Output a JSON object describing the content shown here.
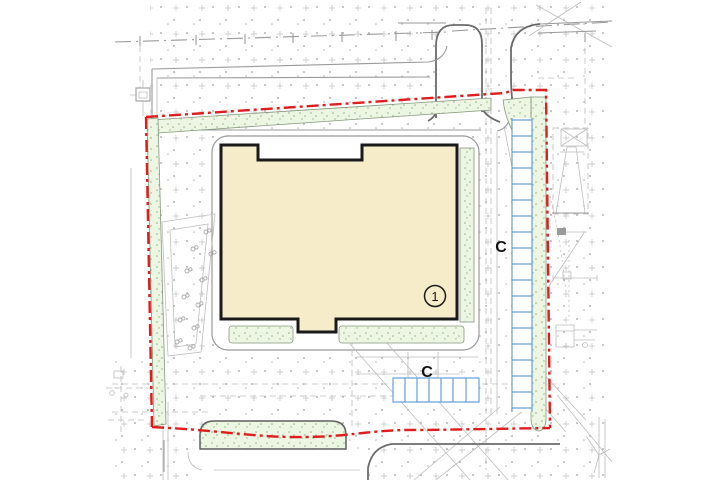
{
  "labels": {
    "building_number": "1",
    "parking_zone_right": "C",
    "parking_zone_bottom": "C"
  },
  "colors": {
    "building-fill": "#f6ecca",
    "building-outline": "#1a1a1a",
    "boundary-red": "#e01c1c",
    "green-fill": "#edf5e3",
    "green-speckle": "#93b483",
    "green-border": "#84977c",
    "parking-blue": "#64a0d8",
    "curb-dark": "#6b6b6b",
    "curb-light": "#9a9a9a",
    "faint": "#bdbdbd",
    "stipple-dot": "#b3b3b3",
    "stipple-plus": "#c4c4c4",
    "label-text": "#111111"
  }
}
